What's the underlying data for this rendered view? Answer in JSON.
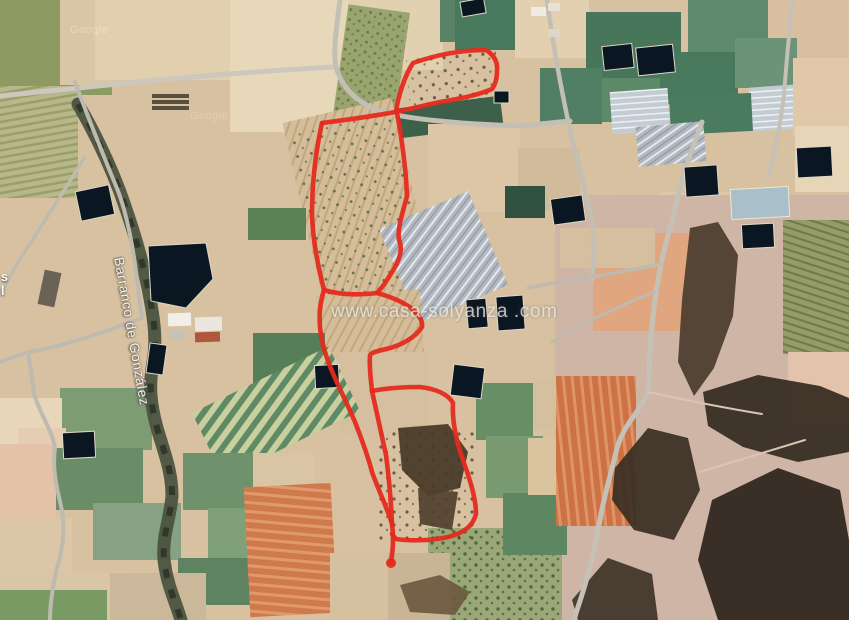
{
  "page": {
    "width": 849,
    "height": 620,
    "kind": "satellite-map-screenshot"
  },
  "labels": {
    "watermark": "www.casa-solyanza .com",
    "ravine": "Barranco de González",
    "imagery_credit_1": "Google",
    "imagery_credit_2": "Google",
    "edge_cutoff_line1": "s",
    "edge_cutoff_line2": "l"
  },
  "colors": {
    "boundary_red": "#e52a1e",
    "pond_navy": "#0b1623",
    "road_gray": "#c4bfb5",
    "terrain_tan": "#d7c1a1"
  },
  "map": {
    "base_color": "#d7c1a1",
    "pond_color": "#0b1623",
    "pond_stroke": "#ded7c4",
    "fields": [
      [
        0,
        0,
        112,
        95,
        "#8d9a62",
        0
      ],
      [
        0,
        86,
        78,
        112,
        "url(#p-rows-olive)",
        0
      ],
      [
        60,
        0,
        55,
        85,
        "#d9c6a6",
        0
      ],
      [
        95,
        0,
        138,
        80,
        "#e2cfae",
        0
      ],
      [
        230,
        0,
        120,
        132,
        "#e7d8ba",
        0
      ],
      [
        348,
        0,
        95,
        70,
        "#e2d1b1",
        0
      ],
      [
        340,
        8,
        62,
        118,
        "url(#p-speck-olive)",
        8
      ],
      [
        440,
        0,
        38,
        42,
        "#5a8266",
        0
      ],
      [
        455,
        0,
        64,
        50,
        "#49795c",
        0
      ],
      [
        515,
        0,
        74,
        58,
        "#e3d0b0",
        0
      ],
      [
        586,
        12,
        95,
        68,
        "#47765a",
        0
      ],
      [
        688,
        0,
        84,
        52,
        "#5d8a6c",
        0
      ],
      [
        768,
        0,
        81,
        62,
        "#d7bfa0",
        0
      ],
      [
        598,
        78,
        64,
        44,
        "#5c8a68",
        0
      ],
      [
        660,
        52,
        78,
        52,
        "#48795c",
        0
      ],
      [
        735,
        38,
        62,
        50,
        "#6a9377",
        0
      ],
      [
        611,
        90,
        58,
        42,
        "url(#p-solar)",
        -4
      ],
      [
        750,
        86,
        48,
        44,
        "url(#p-solar)",
        -4
      ],
      [
        793,
        58,
        56,
        78,
        "#e0c8a8",
        0
      ],
      [
        670,
        95,
        82,
        38,
        "#4a7b5e",
        -3
      ],
      [
        795,
        126,
        54,
        66,
        "#e6d5b6",
        0
      ],
      [
        408,
        50,
        90,
        60,
        "url(#p-speck-dark)",
        -5
      ],
      [
        398,
        102,
        104,
        30,
        "#3c6049",
        -7
      ],
      [
        540,
        68,
        62,
        56,
        "#517f63",
        0
      ],
      [
        560,
        138,
        58,
        56,
        "#d8c2a2",
        0
      ],
      [
        428,
        124,
        92,
        88,
        "#dcc6a6",
        0
      ],
      [
        518,
        148,
        62,
        62,
        "#d2bb9a",
        0
      ],
      [
        505,
        186,
        40,
        32,
        "#315140",
        0
      ],
      [
        637,
        124,
        68,
        40,
        "url(#p-greenhouse)",
        -5
      ],
      [
        660,
        192,
        78,
        42,
        "#dcc6a6",
        0
      ],
      [
        555,
        195,
        294,
        428,
        "#cfb5a5",
        0
      ],
      [
        593,
        233,
        102,
        98,
        "#dfa67f",
        0
      ],
      [
        560,
        228,
        95,
        40,
        "#d6bf9f",
        0
      ],
      [
        783,
        220,
        66,
        134,
        "url(#p-vineyard)",
        0
      ],
      [
        788,
        352,
        61,
        72,
        "#e3c3ab",
        0
      ],
      [
        303,
        108,
        112,
        196,
        "url(#p-rows-tan)",
        -13
      ],
      [
        305,
        118,
        108,
        182,
        "url(#p-speck-teal)",
        -13
      ],
      [
        395,
        206,
        97,
        102,
        "url(#p-greenhouse)",
        -23
      ],
      [
        318,
        293,
        104,
        62,
        "url(#p-rows-tan)",
        -4
      ],
      [
        248,
        208,
        58,
        32,
        "#5c8157",
        0
      ],
      [
        253,
        333,
        72,
        58,
        "#567e57",
        0
      ],
      [
        338,
        352,
        92,
        82,
        "#d5bf9e",
        0
      ],
      [
        200,
        376,
        152,
        72,
        "url(#p-stripes-band)",
        -26
      ],
      [
        60,
        388,
        92,
        62,
        "#7d9c74",
        0
      ],
      [
        0,
        398,
        62,
        46,
        "#e7d6b8",
        0
      ],
      [
        18,
        428,
        48,
        58,
        "#e4cdb0",
        0
      ],
      [
        55,
        448,
        88,
        62,
        "#6a8d68",
        0
      ],
      [
        0,
        444,
        56,
        78,
        "#e3c2a8",
        0
      ],
      [
        93,
        503,
        88,
        57,
        "#86a183",
        0
      ],
      [
        0,
        518,
        72,
        58,
        "#dbc6a8",
        0
      ],
      [
        183,
        453,
        72,
        57,
        "#6f926c",
        0
      ],
      [
        208,
        508,
        78,
        52,
        "#7fa078",
        0
      ],
      [
        178,
        558,
        84,
        47,
        "#5f8260",
        0
      ],
      [
        253,
        453,
        62,
        57,
        "#d9c4a4",
        0
      ],
      [
        247,
        485,
        87,
        130,
        "url(#p-stripes-orange)",
        -3
      ],
      [
        0,
        572,
        132,
        48,
        "#d9c6a6",
        0
      ],
      [
        0,
        590,
        107,
        30,
        "#7a9a64",
        0
      ],
      [
        110,
        573,
        96,
        47,
        "#cbb89a",
        0
      ],
      [
        330,
        553,
        82,
        67,
        "#d5c0a0",
        0
      ],
      [
        428,
        528,
        134,
        92,
        "url(#p-speck-green)",
        0
      ],
      [
        388,
        553,
        62,
        67,
        "#c9b596",
        0
      ],
      [
        476,
        383,
        57,
        57,
        "#688e66",
        0
      ],
      [
        486,
        436,
        57,
        62,
        "#7a9a72",
        0
      ],
      [
        503,
        493,
        64,
        62,
        "#5d8760",
        0
      ],
      [
        528,
        438,
        30,
        57,
        "#d9c49f",
        0
      ],
      [
        533,
        378,
        42,
        52,
        "#d4bf9f",
        0
      ],
      [
        556,
        376,
        80,
        150,
        "url(#p-stripes-orange2)",
        0
      ],
      [
        375,
        428,
        102,
        112,
        "url(#p-speck-dark)",
        0
      ]
    ],
    "scrub": [
      [
        "690,228 718,222 738,255 733,316 714,368 694,396 678,362 682,300",
        "#4a3c2e"
      ],
      [
        "703,392 758,375 820,386 849,398 849,452 798,462 743,447 708,426",
        "#342a20"
      ],
      [
        "615,468 648,428 688,438 700,490 674,540 634,530 612,500",
        "#3a2f23"
      ],
      [
        "712,500 778,468 840,490 849,540 849,620 718,620 698,560",
        "#2c241c"
      ],
      [
        "572,600 608,558 652,574 658,620 578,620",
        "#3f3428"
      ],
      [
        "398,428 448,424 468,452 460,488 428,496 402,470",
        "#453826"
      ],
      [
        "418,488 458,492 452,530 420,524",
        "#50402c"
      ],
      [
        "400,585 440,575 470,592 455,615 410,612",
        "#6c5a40"
      ]
    ],
    "ravine": {
      "d": "M78,104 C92,128 108,160 120,192 C130,220 140,250 148,288 C154,318 157,340 153,362 C149,385 150,402 157,428 C165,455 172,472 172,496 C170,520 162,536 164,560 C167,585 175,600 181,620",
      "outer_color": "#4b5340",
      "inner_color": "#2c3326"
    },
    "roads": [
      {
        "d": "M0,96 C80,88 200,74 335,67",
        "w": 5,
        "c": "#cdc8be"
      },
      {
        "d": "M340,0 C336,30 333,52 336,67 C342,88 356,102 380,111 C405,119 460,124 520,126 L570,121",
        "w": 5,
        "c": "#c4bfb5"
      },
      {
        "d": "M75,82 C86,112 102,152 116,186 C127,212 135,255 140,305 L142,318",
        "w": 4,
        "c": "#bfbab0"
      },
      {
        "d": "M142,318 C110,330 60,348 28,352 L0,362",
        "w": 4,
        "c": "#bfbab0"
      },
      {
        "d": "M28,352 C31,372 33,384 34,394 C41,416 52,430 55,448 C52,470 57,488 61,506 C65,526 64,546 57,568 C52,590 50,605 50,620",
        "w": 4,
        "c": "#bfbab0"
      },
      {
        "d": "M84,158 C62,195 40,228 18,262 L0,295",
        "w": 3.5,
        "c": "#bfbab0"
      },
      {
        "d": "M547,0 C553,45 562,95 574,148 C583,180 589,205 592,222 C595,248 594,265 592,280",
        "w": 4.5,
        "c": "#c4bfb5"
      },
      {
        "d": "M702,122 C690,155 681,178 678,196 C670,232 663,250 661,265 C655,292 652,320 650,352 C649,372 649,385 648,392 C640,412 625,422 617,448 C610,478 603,500 600,520 C594,552 588,578 577,610 L574,620",
        "w": 5,
        "c": "#c6c1b7"
      },
      {
        "d": "M662,264 C630,270 595,277 560,282 L528,288",
        "w": 3.5,
        "c": "#bfbab0"
      },
      {
        "d": "M655,292 C625,303 590,320 562,336 L552,342",
        "w": 3,
        "c": "#bfbab0"
      },
      {
        "d": "M793,0 C788,40 786,70 784,95 C781,120 776,148 768,178",
        "w": 4,
        "c": "#c6c1b7"
      },
      {
        "d": "M648,392 C685,400 725,408 762,414",
        "w": 2,
        "c": "#d8c5b2"
      },
      {
        "d": "M700,472 C733,462 772,450 805,440",
        "w": 2,
        "c": "#d8c5b2"
      }
    ],
    "ponds": [
      {
        "x": 78,
        "y": 188,
        "w": 34,
        "h": 30,
        "rot": -12
      },
      {
        "x": 148,
        "y": 344,
        "w": 17,
        "h": 30,
        "rot": 8
      },
      {
        "x": 63,
        "y": 432,
        "w": 32,
        "h": 26,
        "rot": -3
      },
      {
        "x": 461,
        "y": 0,
        "w": 24,
        "h": 15,
        "rot": -10
      },
      {
        "x": 494,
        "y": 91,
        "w": 15,
        "h": 12,
        "rot": 0
      },
      {
        "x": 603,
        "y": 45,
        "w": 30,
        "h": 24,
        "rot": -6
      },
      {
        "x": 637,
        "y": 46,
        "w": 37,
        "h": 28,
        "rot": -6
      },
      {
        "x": 685,
        "y": 166,
        "w": 33,
        "h": 30,
        "rot": -4
      },
      {
        "x": 742,
        "y": 224,
        "w": 32,
        "h": 24,
        "rot": -3
      },
      {
        "x": 797,
        "y": 147,
        "w": 35,
        "h": 30,
        "rot": -3
      },
      {
        "x": 552,
        "y": 197,
        "w": 32,
        "h": 26,
        "rot": -8
      },
      {
        "x": 467,
        "y": 299,
        "w": 20,
        "h": 29,
        "rot": -5
      },
      {
        "x": 497,
        "y": 296,
        "w": 27,
        "h": 34,
        "rot": -4
      },
      {
        "x": 452,
        "y": 366,
        "w": 31,
        "h": 31,
        "rot": 7
      },
      {
        "x": 315,
        "y": 365,
        "w": 24,
        "h": 23,
        "rot": -3
      },
      {
        "x": 731,
        "y": 188,
        "w": 58,
        "h": 30,
        "rot": -3,
        "fill": "#a9bfc9",
        "stroke": "#efe8d4"
      }
    ],
    "pond_polygons": [
      {
        "pts": "148,246 206,243 213,279 186,308 151,301"
      }
    ],
    "buildings": [
      [
        152,
        94,
        37,
        4,
        "#58503f",
        0
      ],
      [
        152,
        100,
        37,
        4,
        "#58503f",
        0
      ],
      [
        152,
        106,
        37,
        4,
        "#58503f",
        0
      ],
      [
        168,
        313,
        23,
        13,
        "#f2efe8",
        -2
      ],
      [
        195,
        317,
        27,
        14,
        "#ebe7df",
        -2
      ],
      [
        195,
        332,
        25,
        10,
        "#b0563c",
        -2
      ],
      [
        169,
        330,
        17,
        9,
        "#c8c2b6",
        0
      ],
      [
        531,
        7,
        15,
        9,
        "#efece4",
        0
      ],
      [
        548,
        3,
        12,
        8,
        "#e6e2d8",
        0
      ],
      [
        549,
        29,
        11,
        8,
        "#dcd7cb",
        0
      ],
      [
        41,
        271,
        17,
        35,
        "#6b6257",
        12
      ]
    ],
    "boundary": {
      "color": "#e52a1e",
      "width": 4.6,
      "opacity": 0.95,
      "paths": [
        "M413,63 C436,55 462,50 486,50 C494,55 498,62 497,71 C497,79 495,85 492,89 C476,96 457,99 440,102 L396,112 C398,97 404,77 413,63 Z",
        "M395,112 C375,116 345,120 322,123",
        "M397,113 C402,140 406,170 407,196 C403,212 397,228 399,240 C403,248 400,260 392,272 C386,282 380,290 377,293",
        "M322,123 C316,150 312,180 312,215 C313,240 317,262 324,290",
        "M324,290 C340,295 360,295 377,293 C388,296 400,300 411,308 C418,314 423,320 422,327 C415,338 400,346 386,349 C378,351 372,352 370,355 C369,368 371,380 372,391",
        "M324,290 C318,308 318,330 325,352 C332,375 345,398 355,422 C362,440 368,456 372,472 C380,494 388,510 392,524 C394,538 393,550 391,562",
        "M372,391 C376,410 381,432 386,455 C389,478 391,500 392,524",
        "M372,391 C382,389 400,387 420,387 C436,389 448,394 453,403 C452,420 456,440 463,460 C470,480 476,498 476,514 C473,526 464,533 448,537 C430,541 410,541 396,539 L392,534"
      ],
      "end_dot": {
        "cx": 391,
        "cy": 563,
        "r": 5
      }
    }
  }
}
